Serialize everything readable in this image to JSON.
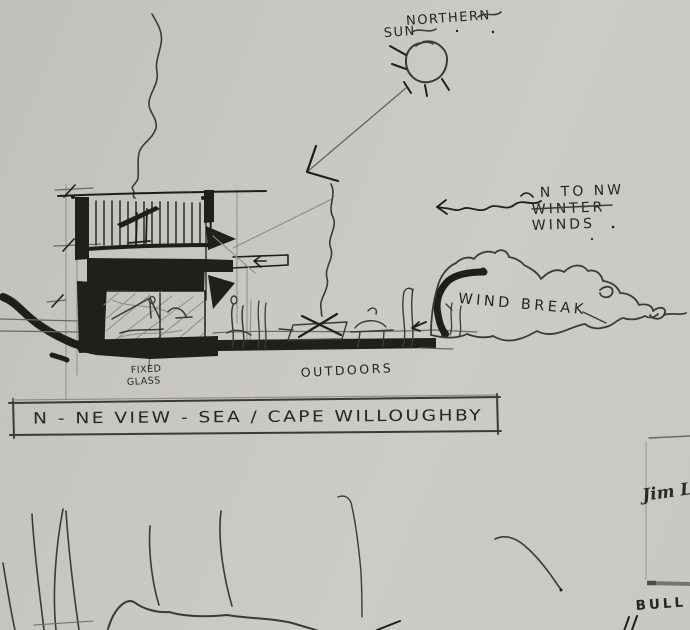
{
  "sketch": {
    "annotations": {
      "northern_sun_1": "NORTHERN",
      "northern_sun_2": "SUN",
      "winds_1": "N TO NW",
      "winds_2": "WINTER",
      "winds_3": "WINDS",
      "wind_break": "WIND BREAK",
      "fixed_glass_1": "FIXED",
      "fixed_glass_2": "GLASS",
      "outdoors": "OUTDOORS"
    },
    "title_block": {
      "text": "N - NE VIEW - SEA / CAPE WILLOUGHBY"
    },
    "margin_notes": {
      "signature": "Jim L",
      "stamp": "BULL"
    },
    "colors": {
      "paper": "#c9c8c3",
      "ink": "#1f1e1b",
      "pencil": "#6b6964"
    }
  }
}
